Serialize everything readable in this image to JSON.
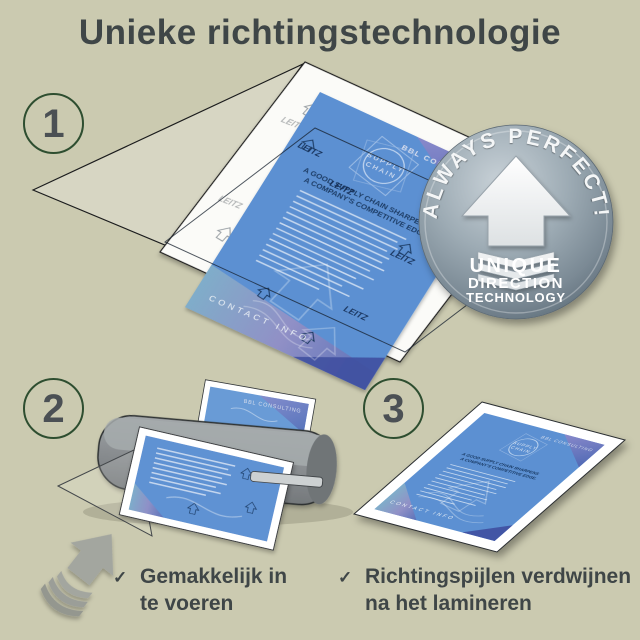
{
  "title": "Unieke richtingstechnologie",
  "steps": {
    "one": {
      "number": "1"
    },
    "two": {
      "number": "2",
      "check": "✓",
      "caption_line1": "Gemakkelijk in",
      "caption_line2": "te voeren"
    },
    "three": {
      "number": "3",
      "check": "✓",
      "caption_line1": "Richtingspijlen verdwijnen",
      "caption_line2": "na het lamineren"
    }
  },
  "badge": {
    "arc_text": "ALWAYS PERFECT!",
    "line1": "UNIQUE",
    "line2": "DIRECTION",
    "line3": "TECHNOLOGY"
  },
  "flyer": {
    "brand": "BBL CONSULTING",
    "emblem_line1": "SUPPLY",
    "emblem_line2": "CHAIN",
    "headline_line1": "A GOOD SUPPLY CHAIN SHARPENS",
    "headline_line2": "A COMPANY'S COMPETITIVE EDGE.",
    "footer": "CONTACT INFO",
    "watermark": "LEITZ"
  },
  "colors": {
    "background": "#cbcab0",
    "text": "#3f4647",
    "step_circle_green": "#2e4e30",
    "step_number_gray": "#4b5054",
    "flyer_blue": "#5b90d2",
    "flyer_navy": "#1a3a64",
    "badge_silver_light": "#c6cfd5",
    "badge_silver_dark": "#5e6d79",
    "laminator_gray": "#85898c",
    "feed_arrow_gray": "#a3a69f"
  }
}
